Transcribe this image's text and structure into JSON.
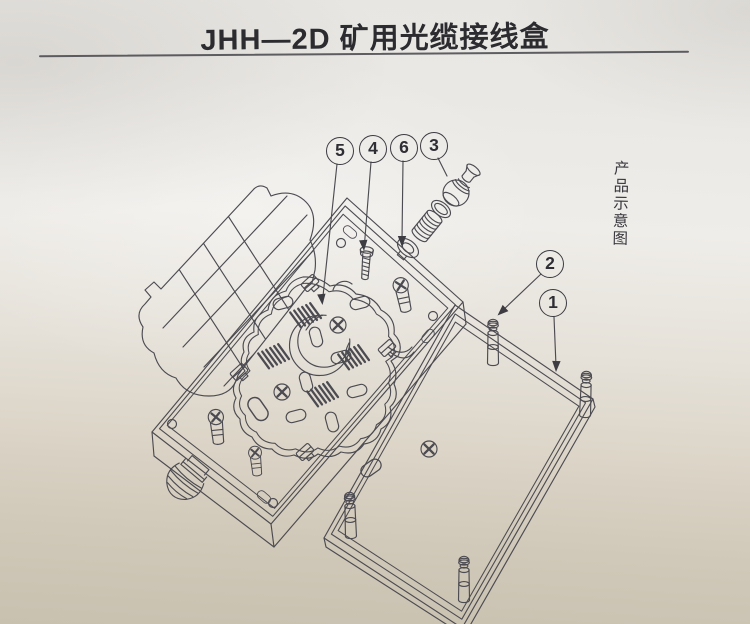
{
  "page": {
    "title": "JHH—2D 矿用光缆接线盒",
    "side_caption": "产品示意图"
  },
  "callouts": [
    {
      "number": "5"
    },
    {
      "number": "4"
    },
    {
      "number": "6"
    },
    {
      "number": "3"
    },
    {
      "number": "2"
    },
    {
      "number": "1"
    }
  ],
  "colors": {
    "ink": "#4c4b51",
    "title_ink": "#2b2b30",
    "paper_top": "#eae8e4",
    "paper_mid": "#efede9",
    "paper_bottom": "#c9c1b0"
  }
}
